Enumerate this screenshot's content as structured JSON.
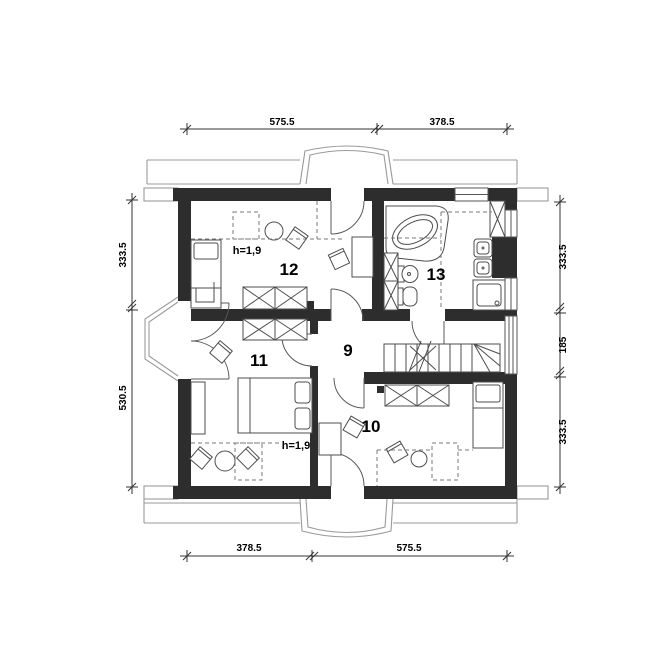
{
  "plan": {
    "room_labels": {
      "hall": "9",
      "bedroom_bottom": "10",
      "bedroom_left": "11",
      "bedroom_top": "12",
      "bathroom": "13"
    },
    "knee_wall_height_top": "h=1,9",
    "knee_wall_height_bottom": "h=1,9",
    "dims": {
      "top_left": "575.5",
      "top_right": "378.5",
      "bottom_left": "378.5",
      "bottom_right": "575.5",
      "left_upper": "333.5",
      "left_lower": "530.5",
      "right_upper": "333.5",
      "right_middle": "185",
      "right_lower": "333.5"
    },
    "colors": {
      "wall_fill": "#2d2d2d",
      "furniture_line": "#4d4d4d",
      "roof_line": "#9a9a9a",
      "dashed_line": "#7a7a7a",
      "dimension_line": "#333333",
      "text": "#000000",
      "background": "#ffffff"
    }
  }
}
